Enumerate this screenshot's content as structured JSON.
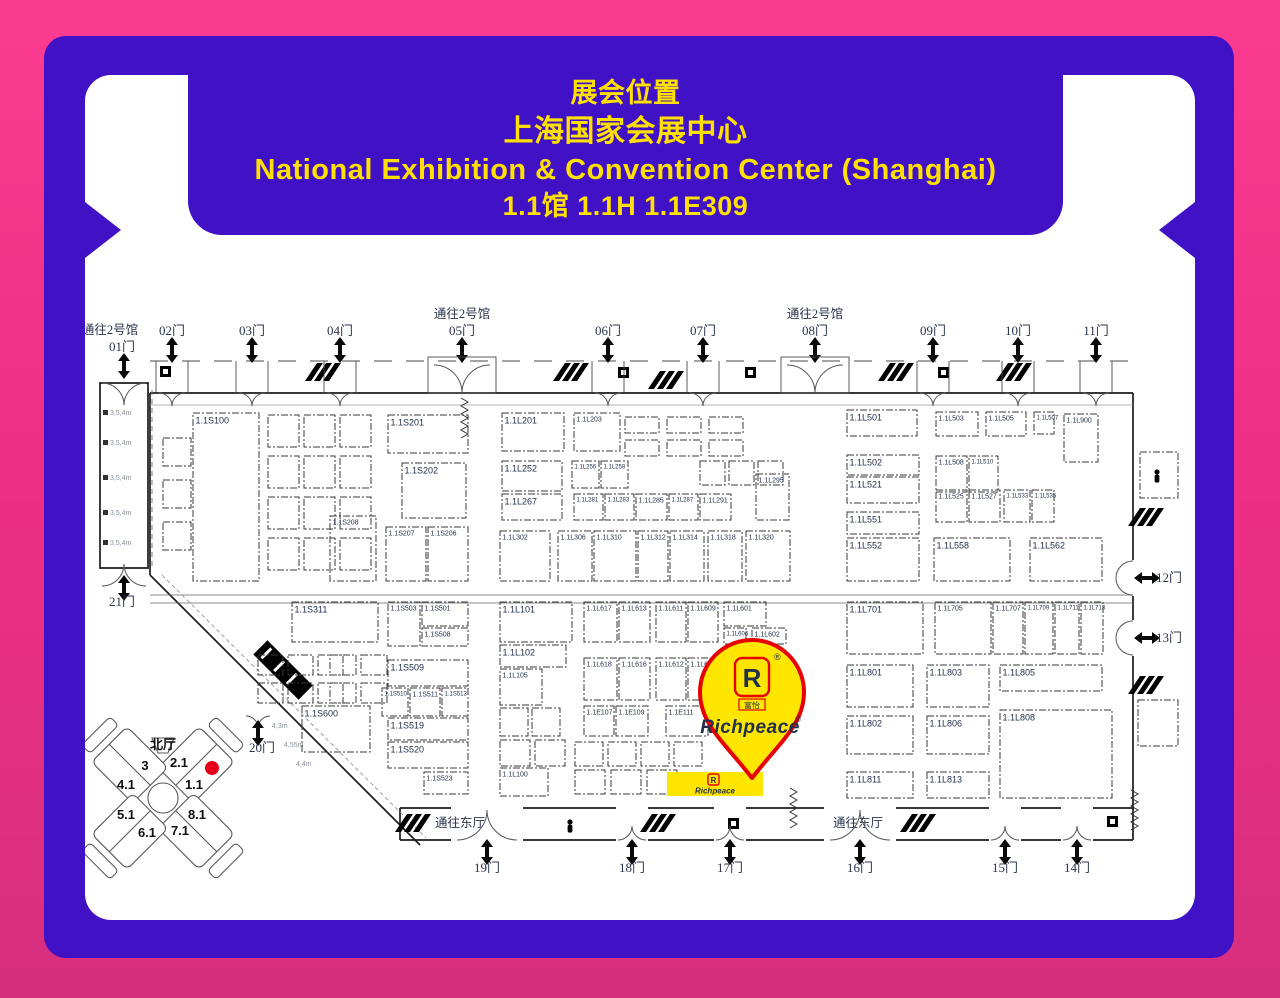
{
  "frame": {
    "bg_top": "#fb3c90",
    "bg_bottom": "#d62f80",
    "panel_color": "#4011c5",
    "map_bg": "#ffffff",
    "accent_yellow": "#ffe000"
  },
  "banner": {
    "lines": [
      "展会位置",
      "上海国家会展中心",
      "National Exhibition & Convention Center (Shanghai)",
      "1.1馆 1.1H 1.1E309"
    ]
  },
  "map": {
    "gates_top": [
      {
        "label": "01门",
        "x": 124,
        "passage": "通往2号馆",
        "big": true,
        "corridor": true
      },
      {
        "label": "02门",
        "x": 172
      },
      {
        "label": "03门",
        "x": 252
      },
      {
        "label": "04门",
        "x": 340
      },
      {
        "label": "05门",
        "x": 462,
        "passage": "通往2号馆",
        "big": true
      },
      {
        "label": "06门",
        "x": 608
      },
      {
        "label": "07门",
        "x": 703
      },
      {
        "label": "08门",
        "x": 815,
        "passage": "通往2号馆",
        "big": true
      },
      {
        "label": "09门",
        "x": 933
      },
      {
        "label": "10门",
        "x": 1018
      },
      {
        "label": "11门",
        "x": 1096
      }
    ],
    "gates_bottom": [
      {
        "label": "19门",
        "x": 487,
        "passage": "通往东厅",
        "px": 460,
        "big": true
      },
      {
        "label": "18门",
        "x": 632
      },
      {
        "label": "17门",
        "x": 730
      },
      {
        "label": "16门",
        "x": 860,
        "passage": "通往东厅",
        "px": 858,
        "big": true
      },
      {
        "label": "15门",
        "x": 1005
      },
      {
        "label": "14门",
        "x": 1077
      }
    ],
    "gates_right": [
      {
        "label": "12门",
        "y": 578
      },
      {
        "label": "13门",
        "y": 638
      }
    ],
    "gates_other": [
      {
        "label": "21门",
        "x": 122,
        "y": 604
      },
      {
        "label": "20门",
        "x": 262,
        "y": 750
      }
    ],
    "corridor_height_label": "3,5,4m",
    "diagonal_labels": [
      "4,3m",
      "4,55m",
      "4,4m"
    ],
    "booths": [
      {
        "label": "1.1S100",
        "x": 193,
        "y": 413,
        "w": 66,
        "h": 168
      },
      {
        "label": "1.1S201",
        "x": 388,
        "y": 415,
        "w": 80,
        "h": 38
      },
      {
        "label": "1.1S202",
        "x": 402,
        "y": 463,
        "w": 64,
        "h": 55
      },
      {
        "label": "1.1S208",
        "x": 330,
        "y": 516,
        "w": 46,
        "h": 65
      },
      {
        "label": "1.1S207",
        "x": 386,
        "y": 527,
        "w": 40,
        "h": 54
      },
      {
        "label": "1.1S206",
        "x": 428,
        "y": 527,
        "w": 40,
        "h": 54
      },
      {
        "label": "1.1L201",
        "x": 502,
        "y": 413,
        "w": 62,
        "h": 38
      },
      {
        "label": "1.1L203",
        "x": 574,
        "y": 413,
        "w": 46,
        "h": 38
      },
      {
        "label": "1.1L252",
        "x": 502,
        "y": 461,
        "w": 60,
        "h": 30
      },
      {
        "label": "1.1L256",
        "x": 572,
        "y": 461,
        "w": 27,
        "h": 27
      },
      {
        "label": "1.1L258",
        "x": 601,
        "y": 461,
        "w": 27,
        "h": 27
      },
      {
        "label": "1.1L267",
        "x": 502,
        "y": 494,
        "w": 60,
        "h": 26
      },
      {
        "label": "1.1L281",
        "x": 574,
        "y": 494,
        "w": 29,
        "h": 26
      },
      {
        "label": "1.1L283",
        "x": 605,
        "y": 494,
        "w": 29,
        "h": 26
      },
      {
        "label": "1.1L285",
        "x": 636,
        "y": 494,
        "w": 31,
        "h": 26
      },
      {
        "label": "1.1L287",
        "x": 669,
        "y": 494,
        "w": 29,
        "h": 26
      },
      {
        "label": "1.1L291",
        "x": 700,
        "y": 494,
        "w": 31,
        "h": 26
      },
      {
        "label": "1.1L295",
        "x": 756,
        "y": 474,
        "w": 33,
        "h": 46
      },
      {
        "label": "1.1L302",
        "x": 500,
        "y": 531,
        "w": 50,
        "h": 50
      },
      {
        "label": "1.1L306",
        "x": 558,
        "y": 531,
        "w": 34,
        "h": 50
      },
      {
        "label": "1.1L310",
        "x": 594,
        "y": 531,
        "w": 42,
        "h": 50
      },
      {
        "label": "1.1L312",
        "x": 638,
        "y": 531,
        "w": 30,
        "h": 50
      },
      {
        "label": "1.1L314",
        "x": 670,
        "y": 531,
        "w": 34,
        "h": 50
      },
      {
        "label": "1.1L318",
        "x": 708,
        "y": 531,
        "w": 34,
        "h": 50
      },
      {
        "label": "1.1L320",
        "x": 746,
        "y": 531,
        "w": 44,
        "h": 50
      },
      {
        "label": "1.1L501",
        "x": 847,
        "y": 410,
        "w": 70,
        "h": 26
      },
      {
        "label": "1.1L503",
        "x": 936,
        "y": 412,
        "w": 42,
        "h": 24
      },
      {
        "label": "1.1L505",
        "x": 986,
        "y": 412,
        "w": 40,
        "h": 24
      },
      {
        "label": "1.1L507",
        "x": 1034,
        "y": 412,
        "w": 20,
        "h": 22
      },
      {
        "label": "1.1L900",
        "x": 1064,
        "y": 414,
        "w": 34,
        "h": 48
      },
      {
        "label": "1.1L502",
        "x": 847,
        "y": 455,
        "w": 72,
        "h": 20
      },
      {
        "label": "1.1L521",
        "x": 847,
        "y": 477,
        "w": 72,
        "h": 26
      },
      {
        "label": "1.1L508",
        "x": 936,
        "y": 456,
        "w": 31,
        "h": 36
      },
      {
        "label": "1.1L510",
        "x": 969,
        "y": 456,
        "w": 29,
        "h": 36
      },
      {
        "label": "1.1L525",
        "x": 936,
        "y": 490,
        "w": 31,
        "h": 32
      },
      {
        "label": "1.1L527",
        "x": 969,
        "y": 490,
        "w": 31,
        "h": 32
      },
      {
        "label": "1.1L533",
        "x": 1004,
        "y": 490,
        "w": 26,
        "h": 32
      },
      {
        "label": "1.1L535",
        "x": 1032,
        "y": 490,
        "w": 22,
        "h": 32
      },
      {
        "label": "1.1L551",
        "x": 847,
        "y": 512,
        "w": 72,
        "h": 22
      },
      {
        "label": "1.1L552",
        "x": 847,
        "y": 538,
        "w": 72,
        "h": 43
      },
      {
        "label": "1.1L558",
        "x": 934,
        "y": 538,
        "w": 76,
        "h": 43
      },
      {
        "label": "1.1L562",
        "x": 1030,
        "y": 538,
        "w": 72,
        "h": 43
      },
      {
        "label": "1.1S311",
        "x": 292,
        "y": 602,
        "w": 86,
        "h": 40
      },
      {
        "label": "1.1S503",
        "x": 388,
        "y": 602,
        "w": 32,
        "h": 44
      },
      {
        "label": "1.1S501",
        "x": 422,
        "y": 602,
        "w": 46,
        "h": 24
      },
      {
        "label": "1.1S508",
        "x": 422,
        "y": 628,
        "w": 46,
        "h": 18
      },
      {
        "label": "1.1S509",
        "x": 388,
        "y": 660,
        "w": 80,
        "h": 26
      },
      {
        "label": "1.1S510",
        "x": 382,
        "y": 688,
        "w": 26,
        "h": 28
      },
      {
        "label": "1.1S511",
        "x": 410,
        "y": 688,
        "w": 30,
        "h": 28
      },
      {
        "label": "1.1S513",
        "x": 442,
        "y": 688,
        "w": 26,
        "h": 28
      },
      {
        "label": "1.1S519",
        "x": 388,
        "y": 718,
        "w": 80,
        "h": 22
      },
      {
        "label": "1.1S520",
        "x": 388,
        "y": 742,
        "w": 80,
        "h": 26
      },
      {
        "label": "1.1S523",
        "x": 424,
        "y": 772,
        "w": 44,
        "h": 22
      },
      {
        "label": "1.1S600",
        "x": 302,
        "y": 706,
        "w": 68,
        "h": 46
      },
      {
        "label": "1.1L101",
        "x": 500,
        "y": 602,
        "w": 72,
        "h": 40
      },
      {
        "label": "1.1L617",
        "x": 584,
        "y": 602,
        "w": 33,
        "h": 40
      },
      {
        "label": "1.1L613",
        "x": 619,
        "y": 602,
        "w": 31,
        "h": 40
      },
      {
        "label": "1.1L611",
        "x": 656,
        "y": 602,
        "w": 30,
        "h": 40
      },
      {
        "label": "1.1L609",
        "x": 688,
        "y": 602,
        "w": 30,
        "h": 40
      },
      {
        "label": "1.1L601",
        "x": 724,
        "y": 602,
        "w": 42,
        "h": 24
      },
      {
        "label": "1.1L606",
        "x": 724,
        "y": 628,
        "w": 22,
        "h": 16
      },
      {
        "label": "1.1L602",
        "x": 752,
        "y": 628,
        "w": 34,
        "h": 16
      },
      {
        "label": "1.1L102",
        "x": 500,
        "y": 645,
        "w": 66,
        "h": 22
      },
      {
        "label": "1.1L105",
        "x": 500,
        "y": 669,
        "w": 42,
        "h": 36
      },
      {
        "label": "1.1L618",
        "x": 584,
        "y": 658,
        "w": 33,
        "h": 42
      },
      {
        "label": "1.1L616",
        "x": 619,
        "y": 658,
        "w": 31,
        "h": 42
      },
      {
        "label": "1.1L612",
        "x": 656,
        "y": 658,
        "w": 30,
        "h": 42
      },
      {
        "label": "1.1L610",
        "x": 688,
        "y": 658,
        "w": 30,
        "h": 42
      },
      {
        "label": "1.1E107",
        "x": 584,
        "y": 706,
        "w": 30,
        "h": 30
      },
      {
        "label": "1.1E109",
        "x": 616,
        "y": 706,
        "w": 32,
        "h": 30
      },
      {
        "label": "1.1E111",
        "x": 666,
        "y": 706,
        "w": 42,
        "h": 30
      },
      {
        "label": "1.1L100",
        "x": 500,
        "y": 768,
        "w": 48,
        "h": 28
      },
      {
        "label": "1.1L701",
        "x": 847,
        "y": 602,
        "w": 76,
        "h": 52
      },
      {
        "label": "1.1L705",
        "x": 935,
        "y": 602,
        "w": 56,
        "h": 52
      },
      {
        "label": "1.1L707",
        "x": 993,
        "y": 602,
        "w": 30,
        "h": 52
      },
      {
        "label": "1.1L709",
        "x": 1025,
        "y": 602,
        "w": 28,
        "h": 52
      },
      {
        "label": "1.1L711",
        "x": 1055,
        "y": 602,
        "w": 24,
        "h": 52
      },
      {
        "label": "1.1L713",
        "x": 1081,
        "y": 602,
        "w": 22,
        "h": 52
      },
      {
        "label": "1.1L801",
        "x": 847,
        "y": 665,
        "w": 66,
        "h": 42
      },
      {
        "label": "1.1L803",
        "x": 927,
        "y": 665,
        "w": 62,
        "h": 42
      },
      {
        "label": "1.1L805",
        "x": 1000,
        "y": 665,
        "w": 102,
        "h": 26
      },
      {
        "label": "1.1L802",
        "x": 847,
        "y": 716,
        "w": 66,
        "h": 38
      },
      {
        "label": "1.1L806",
        "x": 927,
        "y": 716,
        "w": 62,
        "h": 38
      },
      {
        "label": "1.1L808",
        "x": 1000,
        "y": 710,
        "w": 112,
        "h": 88
      },
      {
        "label": "1.1L811",
        "x": 847,
        "y": 772,
        "w": 66,
        "h": 26
      },
      {
        "label": "1.1L813",
        "x": 927,
        "y": 772,
        "w": 62,
        "h": 26
      }
    ],
    "minimap": {
      "north_label": "北厅",
      "halls": [
        {
          "label": "3",
          "x": 145,
          "y": 770
        },
        {
          "label": "2.1",
          "x": 179,
          "y": 767
        },
        {
          "label": "4.1",
          "x": 126,
          "y": 789
        },
        {
          "label": "1.1",
          "x": 194,
          "y": 789
        },
        {
          "label": "5.1",
          "x": 126,
          "y": 819
        },
        {
          "label": "8.1",
          "x": 197,
          "y": 819
        },
        {
          "label": "6.1",
          "x": 147,
          "y": 837
        },
        {
          "label": "7.1",
          "x": 180,
          "y": 835
        }
      ],
      "marker_color": "#e8001b"
    },
    "richpeace": {
      "brand": "Richpeace",
      "reg": "®",
      "logo_letter": "R",
      "logo_cn": "富怡",
      "pin_fill": "#ffe600",
      "pin_stroke": "#e60000",
      "brand_color": "#1b2c8a",
      "booth_fill": "#ffe600"
    }
  }
}
